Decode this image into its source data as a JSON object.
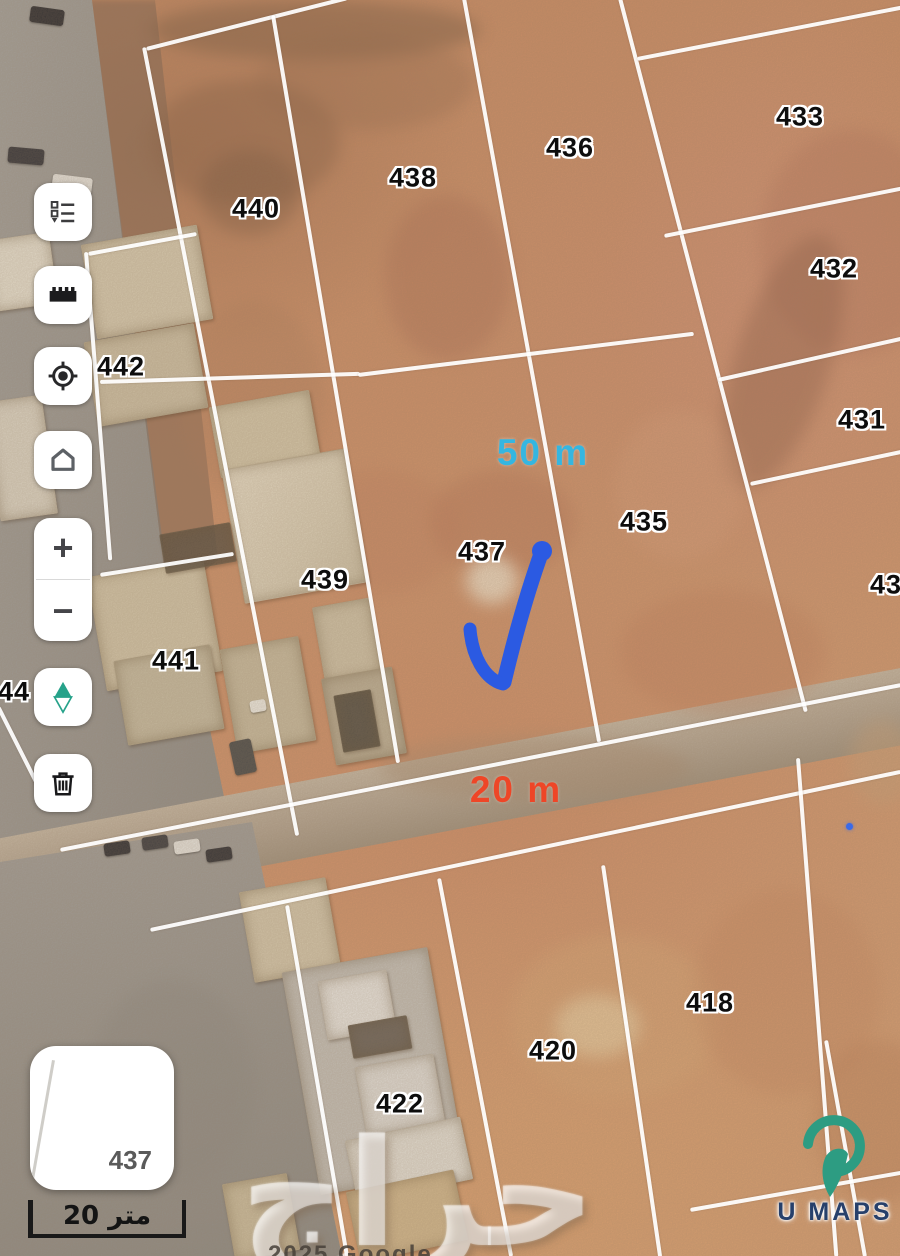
{
  "toolbar": {
    "items": [
      {
        "id": "layers",
        "icon": "list-icon"
      },
      {
        "id": "measure",
        "icon": "ruler-icon"
      },
      {
        "id": "my-location",
        "icon": "locate-icon"
      },
      {
        "id": "home",
        "icon": "home-icon"
      },
      {
        "id": "zoom-in",
        "label": "+"
      },
      {
        "id": "zoom-out",
        "label": "−"
      },
      {
        "id": "compass",
        "icon": "compass-icon"
      },
      {
        "id": "delete",
        "icon": "trash-icon"
      }
    ]
  },
  "parcels": [
    {
      "label": "440"
    },
    {
      "label": "438"
    },
    {
      "label": "436"
    },
    {
      "label": "433"
    },
    {
      "label": "432"
    },
    {
      "label": "431"
    },
    {
      "label": "430"
    },
    {
      "label": "442"
    },
    {
      "label": "441"
    },
    {
      "label": "439"
    },
    {
      "label": "437"
    },
    {
      "label": "435"
    },
    {
      "label": "418"
    },
    {
      "label": "420"
    },
    {
      "label": "422"
    },
    {
      "label": "44"
    }
  ],
  "annotations": {
    "area_width_label": "50 m",
    "area_width_color": "#35b6e0",
    "road_width_label": "20 m",
    "road_width_color": "#ee4627",
    "check_color": "#2b5ae2"
  },
  "shape_card": {
    "parcel_number": "437"
  },
  "scale_bar": {
    "label": "20 متر"
  },
  "branding": {
    "logo_text": "U MAPS",
    "logo_text_color": "#27406b",
    "pin_color": "#2d9c82",
    "watermark": "حراج"
  },
  "attribution": "2025 Google"
}
